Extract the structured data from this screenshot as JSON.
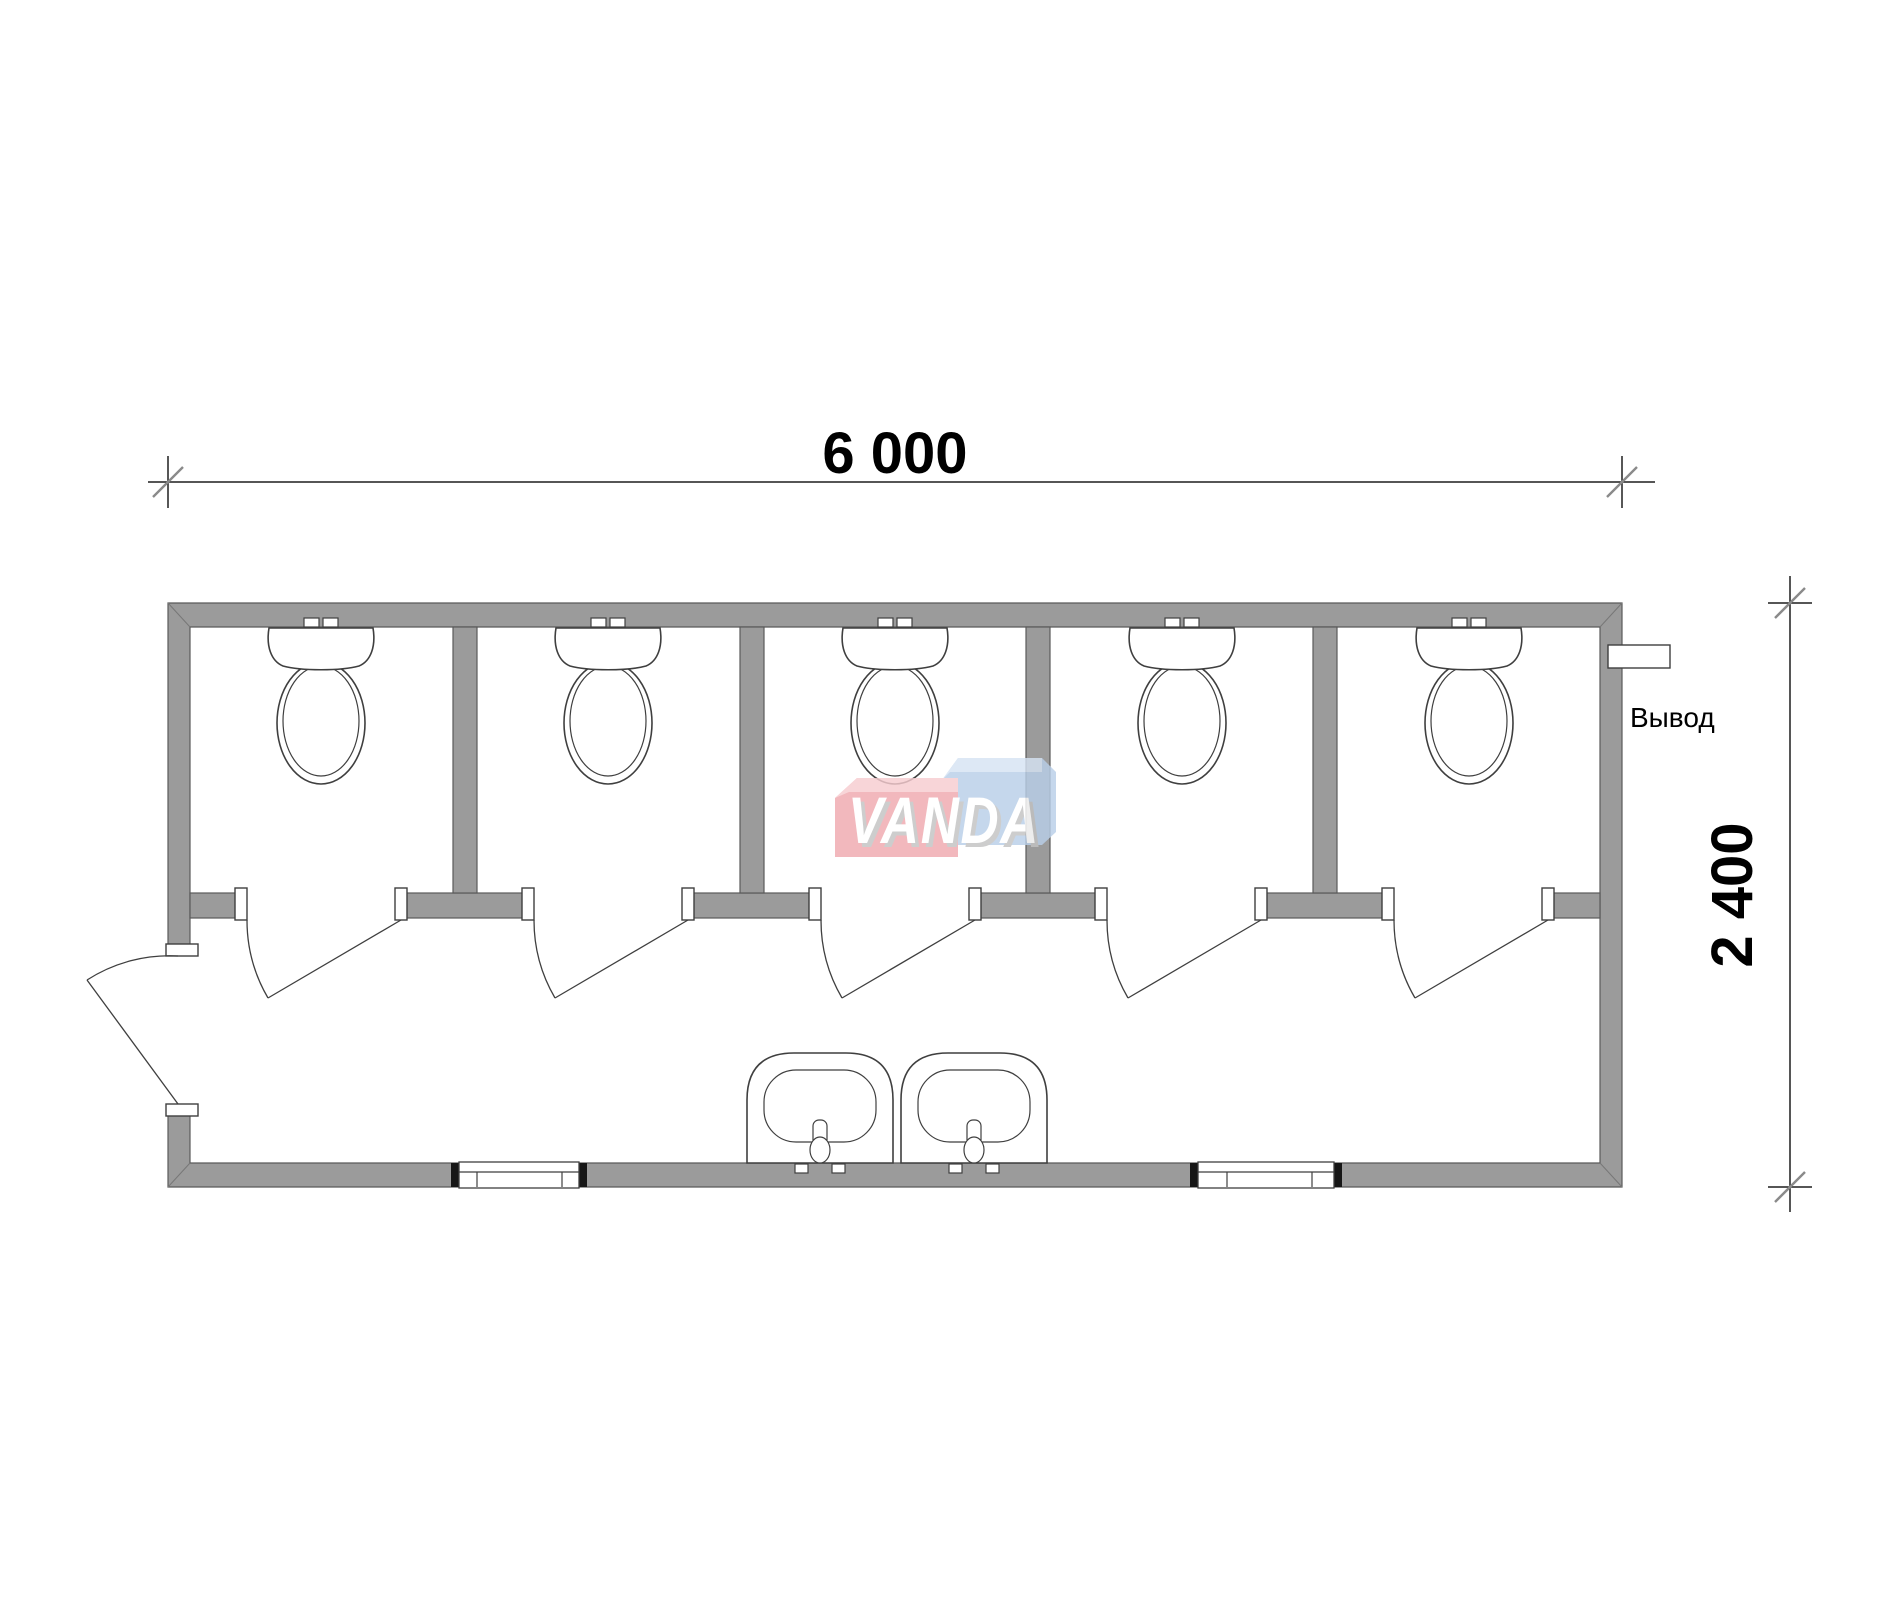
{
  "labels": {
    "width_dimension": "6 000",
    "height_dimension": "2 400",
    "outlet": "Вывод",
    "watermark": "VANDA"
  },
  "colors": {
    "wall": "#9b9b9b",
    "wall-stroke": "#5a5a5a",
    "line": "#3f3f3f",
    "dim": "#1f1f1f",
    "wm-red": "#f0a9af",
    "wm-red-hi": "#f7ccd0",
    "wm-blue": "#b9cfe8",
    "wm-blue-hi": "#d6e3f3",
    "wm-shadow": "#c3c3c3"
  },
  "plan": {
    "stalls": 5,
    "toilets": 5,
    "sinks": 2,
    "windows": 2,
    "stall_doors": 5,
    "entrance_doors": 1
  }
}
